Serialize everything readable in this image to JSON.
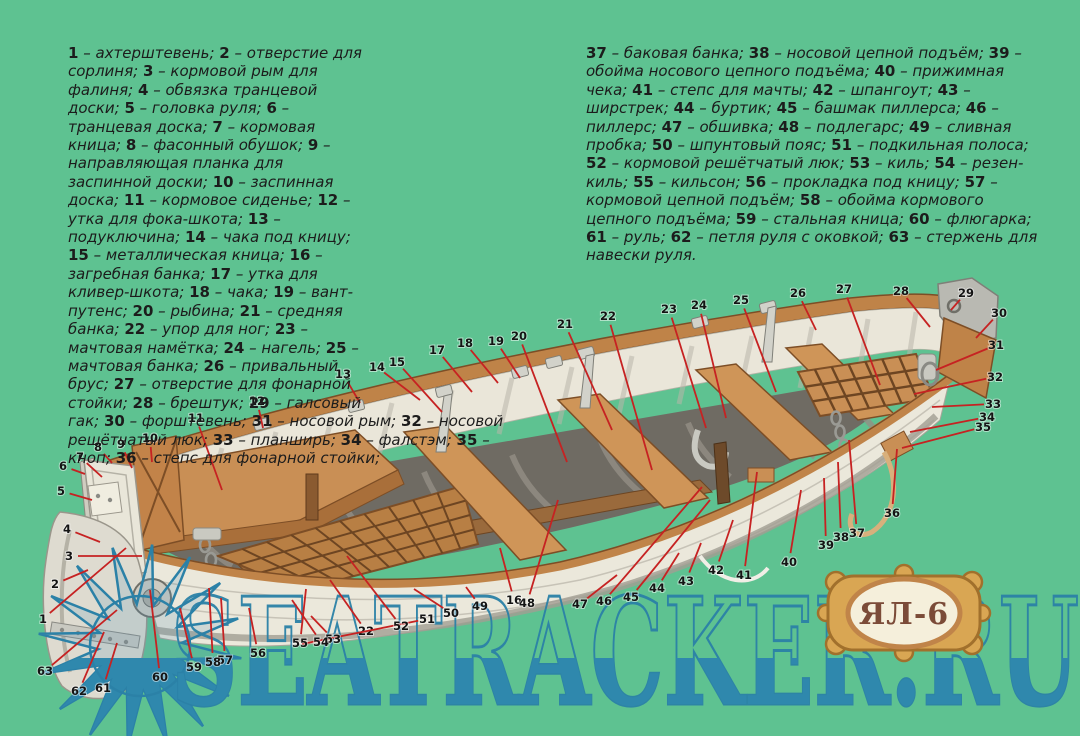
{
  "colors": {
    "background": "#5ec291",
    "wood": "#c98f55",
    "wood_dark": "#7d4e26",
    "hull_white": "#ebe8db",
    "interior_dark": "#6f6b63",
    "metal": "#c9c9c1",
    "callout_line": "#c62222",
    "callout_number": "#141414",
    "watermark_blue": "#2b81a7",
    "watermark_fill": "#2f88ad",
    "badge_gold": "#d9a653",
    "badge_border": "#a1702c",
    "badge_oval": "#f5efdb",
    "badge_text_color": "#7b4b38"
  },
  "badge": {
    "text": "ЯЛ-6"
  },
  "watermark": {
    "text": "SEATRACKER.RU"
  },
  "legend": {
    "separator": " – ",
    "item_terminator": "; ",
    "column1_final": ";",
    "column2_final": ".",
    "column1": [
      {
        "n": "1",
        "name": "ахтерштевень"
      },
      {
        "n": "2",
        "name": "отверстие для сорлиня"
      },
      {
        "n": "3",
        "name": "кормовой рым для фалиня"
      },
      {
        "n": "4",
        "name": "обвязка транцевой доски"
      },
      {
        "n": "5",
        "name": "головка руля"
      },
      {
        "n": "6",
        "name": "транцевая доска"
      },
      {
        "n": "7",
        "name": "кормовая кница"
      },
      {
        "n": "8",
        "name": "фасонный обушок"
      },
      {
        "n": "9",
        "name": "направляющая планка для заспинной доски"
      },
      {
        "n": "10",
        "name": "заспинная доска"
      },
      {
        "n": "11",
        "name": "кормовое сиденье"
      },
      {
        "n": "12",
        "name": "утка для фока-шкота"
      },
      {
        "n": "13",
        "name": "подуключина"
      },
      {
        "n": "14",
        "name": "чака под кницу"
      },
      {
        "n": "15",
        "name": "металлическая кница"
      },
      {
        "n": "16",
        "name": "загребная банка"
      },
      {
        "n": "17",
        "name": "утка для кливер-шкота"
      },
      {
        "n": "18",
        "name": "чака"
      },
      {
        "n": "19",
        "name": "вант-путенс"
      },
      {
        "n": "20",
        "name": "рыбина"
      },
      {
        "n": "21",
        "name": "средняя банка"
      },
      {
        "n": "22",
        "name": "упор для ног"
      },
      {
        "n": "23",
        "name": "мачтовая намётка"
      },
      {
        "n": "24",
        "name": "нагель"
      },
      {
        "n": "25",
        "name": "мачтовая банка"
      },
      {
        "n": "26",
        "name": "привальный брус"
      },
      {
        "n": "27",
        "name": "отверстие для фонарной стойки"
      },
      {
        "n": "28",
        "name": "брештук"
      },
      {
        "n": "29",
        "name": "галсовый гак"
      },
      {
        "n": "30",
        "name": "форштевень"
      },
      {
        "n": "31",
        "name": "носовой рым"
      },
      {
        "n": "32",
        "name": "носовой решётчатый люк"
      },
      {
        "n": "33",
        "name": "планширь"
      },
      {
        "n": "34",
        "name": "фалстэм"
      },
      {
        "n": "35",
        "name": "кноп"
      },
      {
        "n": "36",
        "name": "степс для фонарной стойки"
      }
    ],
    "column2": [
      {
        "n": "37",
        "name": "баковая банка"
      },
      {
        "n": "38",
        "name": "носовой цепной подъём"
      },
      {
        "n": "39",
        "name": "обойма носового цепного подъёма"
      },
      {
        "n": "40",
        "name": "прижимная чека"
      },
      {
        "n": "41",
        "name": "степс для мачты"
      },
      {
        "n": "42",
        "name": "шпангоут"
      },
      {
        "n": "43",
        "name": "ширстрек"
      },
      {
        "n": "44",
        "name": "буртик"
      },
      {
        "n": "45",
        "name": "башмак пиллерса"
      },
      {
        "n": "46",
        "name": "пиллерс"
      },
      {
        "n": "47",
        "name": "обшивка"
      },
      {
        "n": "48",
        "name": "подлегарс"
      },
      {
        "n": "49",
        "name": "сливная пробка"
      },
      {
        "n": "50",
        "name": "шпунтовый пояс"
      },
      {
        "n": "51",
        "name": "подкильная полоса"
      },
      {
        "n": "52",
        "name": "кормовой решётчатый люк"
      },
      {
        "n": "53",
        "name": "киль"
      },
      {
        "n": "54",
        "name": "резен-киль"
      },
      {
        "n": "55",
        "name": "кильсон"
      },
      {
        "n": "56",
        "name": "прокладка под кницу"
      },
      {
        "n": "57",
        "name": "кормовой цепной подъём"
      },
      {
        "n": "58",
        "name": "обойма кормового цепного подъёма"
      },
      {
        "n": "59",
        "name": "стальная кница"
      },
      {
        "n": "60",
        "name": "флюгарка"
      },
      {
        "n": "61",
        "name": "руль"
      },
      {
        "n": "62",
        "name": "петля руля с оковкой"
      },
      {
        "n": "63",
        "name": "стержень для навески руля"
      }
    ]
  },
  "callouts": [
    {
      "n": "1",
      "x": 43,
      "y": 619,
      "tx": 126,
      "ty": 548
    },
    {
      "n": "2",
      "x": 55,
      "y": 584,
      "tx": 88,
      "ty": 570
    },
    {
      "n": "3",
      "x": 69,
      "y": 556,
      "tx": 142,
      "ty": 556
    },
    {
      "n": "4",
      "x": 67,
      "y": 529,
      "tx": 100,
      "ty": 542
    },
    {
      "n": "5",
      "x": 61,
      "y": 491,
      "tx": 92,
      "ty": 500
    },
    {
      "n": "6",
      "x": 63,
      "y": 466,
      "tx": 85,
      "ty": 474
    },
    {
      "n": "7",
      "x": 80,
      "y": 457,
      "tx": 102,
      "ty": 477
    },
    {
      "n": "8",
      "x": 98,
      "y": 447,
      "tx": 112,
      "ty": 463
    },
    {
      "n": "9",
      "x": 121,
      "y": 444,
      "tx": 132,
      "ty": 468
    },
    {
      "n": "10",
      "x": 150,
      "y": 438,
      "tx": 152,
      "ty": 462
    },
    {
      "n": "11",
      "x": 196,
      "y": 418,
      "tx": 222,
      "ty": 490
    },
    {
      "n": "12",
      "x": 257,
      "y": 401,
      "tx": 263,
      "ty": 428
    },
    {
      "n": "13",
      "x": 343,
      "y": 374,
      "tx": 360,
      "ty": 403
    },
    {
      "n": "14",
      "x": 377,
      "y": 367,
      "tx": 420,
      "ty": 400
    },
    {
      "n": "15",
      "x": 397,
      "y": 362,
      "tx": 442,
      "ty": 412
    },
    {
      "n": "16",
      "x": 514,
      "y": 600,
      "tx": 500,
      "ty": 548
    },
    {
      "n": "17",
      "x": 437,
      "y": 350,
      "tx": 472,
      "ty": 392
    },
    {
      "n": "18",
      "x": 465,
      "y": 343,
      "tx": 498,
      "ty": 383
    },
    {
      "n": "19",
      "x": 496,
      "y": 341,
      "tx": 520,
      "ty": 378
    },
    {
      "n": "20",
      "x": 519,
      "y": 336,
      "tx": 567,
      "ty": 462
    },
    {
      "n": "21",
      "x": 565,
      "y": 324,
      "tx": 612,
      "ty": 430
    },
    {
      "n": "22",
      "x": 608,
      "y": 316,
      "tx": 652,
      "ty": 470
    },
    {
      "n": "22",
      "x": 366,
      "y": 631,
      "tx": 330,
      "ty": 580
    },
    {
      "n": "23",
      "x": 669,
      "y": 309,
      "tx": 706,
      "ty": 428
    },
    {
      "n": "24",
      "x": 699,
      "y": 305,
      "tx": 726,
      "ty": 418
    },
    {
      "n": "25",
      "x": 741,
      "y": 300,
      "tx": 776,
      "ty": 392
    },
    {
      "n": "26",
      "x": 798,
      "y": 293,
      "tx": 816,
      "ty": 330
    },
    {
      "n": "27",
      "x": 844,
      "y": 289,
      "tx": 880,
      "ty": 385
    },
    {
      "n": "28",
      "x": 901,
      "y": 291,
      "tx": 930,
      "ty": 327
    },
    {
      "n": "29",
      "x": 966,
      "y": 293,
      "tx": 951,
      "ty": 310
    },
    {
      "n": "30",
      "x": 999,
      "y": 313,
      "tx": 976,
      "ty": 338
    },
    {
      "n": "31",
      "x": 996,
      "y": 345,
      "tx": 936,
      "ty": 370
    },
    {
      "n": "32",
      "x": 995,
      "y": 377,
      "tx": 914,
      "ty": 394
    },
    {
      "n": "33",
      "x": 993,
      "y": 404,
      "tx": 932,
      "ty": 407
    },
    {
      "n": "34",
      "x": 987,
      "y": 417,
      "tx": 910,
      "ty": 432
    },
    {
      "n": "35",
      "x": 983,
      "y": 427,
      "tx": 902,
      "ty": 448
    },
    {
      "n": "36",
      "x": 892,
      "y": 513,
      "tx": 897,
      "ty": 449
    },
    {
      "n": "37",
      "x": 857,
      "y": 533,
      "tx": 849,
      "ty": 440
    },
    {
      "n": "38",
      "x": 841,
      "y": 537,
      "tx": 838,
      "ty": 462
    },
    {
      "n": "39",
      "x": 826,
      "y": 545,
      "tx": 824,
      "ty": 478
    },
    {
      "n": "40",
      "x": 789,
      "y": 562,
      "tx": 801,
      "ty": 490
    },
    {
      "n": "41",
      "x": 744,
      "y": 575,
      "tx": 757,
      "ty": 472
    },
    {
      "n": "42",
      "x": 716,
      "y": 570,
      "tx": 733,
      "ty": 520
    },
    {
      "n": "43",
      "x": 686,
      "y": 581,
      "tx": 701,
      "ty": 543
    },
    {
      "n": "44",
      "x": 657,
      "y": 588,
      "tx": 679,
      "ty": 553
    },
    {
      "n": "45",
      "x": 631,
      "y": 597,
      "tx": 710,
      "ty": 500
    },
    {
      "n": "46",
      "x": 604,
      "y": 601,
      "tx": 702,
      "ty": 487
    },
    {
      "n": "47",
      "x": 580,
      "y": 604,
      "tx": 617,
      "ty": 575
    },
    {
      "n": "48",
      "x": 527,
      "y": 603,
      "tx": 558,
      "ty": 500
    },
    {
      "n": "49",
      "x": 480,
      "y": 606,
      "tx": 466,
      "ty": 587
    },
    {
      "n": "50",
      "x": 451,
      "y": 613,
      "tx": 414,
      "ty": 589
    },
    {
      "n": "51",
      "x": 427,
      "y": 619,
      "tx": 302,
      "ty": 644
    },
    {
      "n": "52",
      "x": 401,
      "y": 626,
      "tx": 347,
      "ty": 556
    },
    {
      "n": "53",
      "x": 333,
      "y": 639,
      "tx": 311,
      "ty": 616
    },
    {
      "n": "54",
      "x": 321,
      "y": 642,
      "tx": 292,
      "ty": 600
    },
    {
      "n": "55",
      "x": 300,
      "y": 643,
      "tx": 306,
      "ty": 589
    },
    {
      "n": "56",
      "x": 258,
      "y": 653,
      "tx": 249,
      "ty": 608
    },
    {
      "n": "57",
      "x": 225,
      "y": 660,
      "tx": 221,
      "ty": 598
    },
    {
      "n": "58",
      "x": 213,
      "y": 662,
      "tx": 209,
      "ty": 588
    },
    {
      "n": "59",
      "x": 194,
      "y": 667,
      "tx": 180,
      "ty": 608
    },
    {
      "n": "60",
      "x": 160,
      "y": 677,
      "tx": 150,
      "ty": 590
    },
    {
      "n": "61",
      "x": 103,
      "y": 688,
      "tx": 117,
      "ty": 643
    },
    {
      "n": "62",
      "x": 79,
      "y": 691,
      "tx": 104,
      "ty": 632
    },
    {
      "n": "63",
      "x": 45,
      "y": 671,
      "tx": 117,
      "ty": 610
    }
  ]
}
